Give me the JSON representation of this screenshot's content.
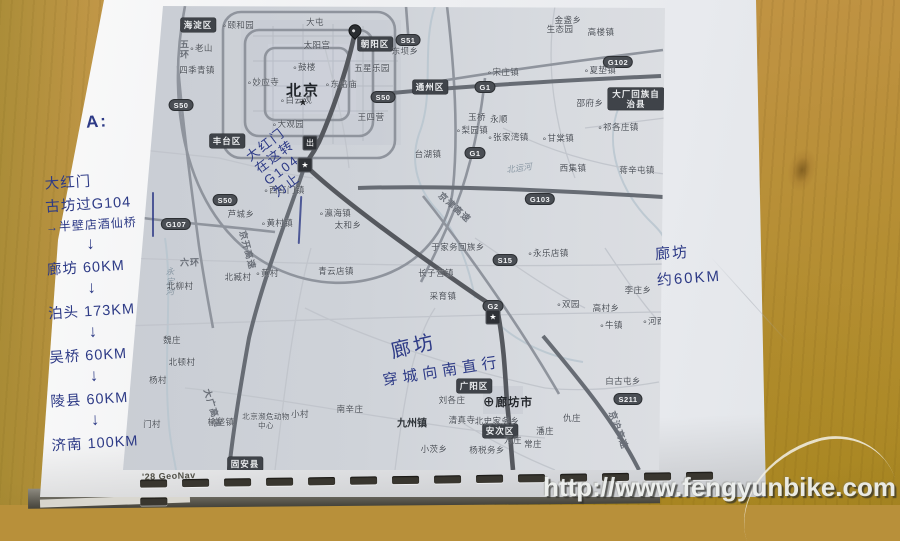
{
  "photo": {
    "watermark": "http://www.fengyunbike.com",
    "map_credit": "'28 GeoNav"
  },
  "handwriting": {
    "label_a": "A:",
    "left_list": [
      {
        "t": "大红门",
        "k": "line"
      },
      {
        "t": "古坊过G104",
        "k": "line"
      },
      {
        "t": "→半壁店酒仙桥",
        "k": "line",
        "small": true
      },
      {
        "t": "↓",
        "k": "arrow"
      },
      {
        "t": "廊坊 60KM",
        "k": "line"
      },
      {
        "t": "↓",
        "k": "arrow"
      },
      {
        "t": "泊头 173KM",
        "k": "line"
      },
      {
        "t": "↓",
        "k": "arrow"
      },
      {
        "t": "吴桥 60KM",
        "k": "line"
      },
      {
        "t": "↓",
        "k": "arrow"
      },
      {
        "t": "陵县 60KM",
        "k": "line"
      },
      {
        "t": "↓",
        "k": "arrow"
      },
      {
        "t": "济南 100KM",
        "k": "line"
      }
    ],
    "map_note_start": [
      "大红门",
      "在这转",
      "G104",
      "为止"
    ],
    "map_note_langfang": {
      "title": "廊坊",
      "line": "穿城向南直行"
    },
    "right_note": [
      "廊坊",
      "约60KM"
    ]
  },
  "binding": {
    "slots": 15
  },
  "map": {
    "labels": [
      {
        "t": "海淀区",
        "x": 75,
        "y": 19,
        "k": "d"
      },
      {
        "t": "朝阳区",
        "x": 252,
        "y": 38,
        "k": "d"
      },
      {
        "t": "通州区",
        "x": 307,
        "y": 81,
        "k": "d"
      },
      {
        "t": "丰台区",
        "x": 104,
        "y": 135,
        "k": "d"
      },
      {
        "t": "大厂回族自治县",
        "x": 513,
        "y": 93,
        "k": "d",
        "wrap": 1
      },
      {
        "t": "广阳区",
        "x": 351,
        "y": 380,
        "k": "d"
      },
      {
        "t": "安次区",
        "x": 377,
        "y": 425,
        "k": "d"
      },
      {
        "t": "固安县",
        "x": 122,
        "y": 458,
        "k": "d"
      },
      {
        "t": "S50",
        "x": 58,
        "y": 99,
        "k": "s"
      },
      {
        "t": "S50",
        "x": 102,
        "y": 194,
        "k": "s"
      },
      {
        "t": "S50",
        "x": 260,
        "y": 91,
        "k": "s"
      },
      {
        "t": "S51",
        "x": 285,
        "y": 34,
        "k": "s"
      },
      {
        "t": "G1",
        "x": 362,
        "y": 81,
        "k": "s"
      },
      {
        "t": "G1",
        "x": 352,
        "y": 147,
        "k": "s"
      },
      {
        "t": "G102",
        "x": 495,
        "y": 56,
        "k": "s"
      },
      {
        "t": "G103",
        "x": 417,
        "y": 193,
        "k": "s"
      },
      {
        "t": "G107",
        "x": 53,
        "y": 218,
        "k": "s"
      },
      {
        "t": "S15",
        "x": 382,
        "y": 254,
        "k": "s"
      },
      {
        "t": "G2",
        "x": 370,
        "y": 300,
        "k": "s"
      },
      {
        "t": "S211",
        "x": 505,
        "y": 393,
        "k": "s"
      },
      {
        "t": "北京",
        "x": 180,
        "y": 84,
        "k": "c"
      },
      {
        "t": "★",
        "x": 180,
        "y": 97,
        "k": "sym"
      },
      {
        "t": "廊坊市",
        "x": 385,
        "y": 396,
        "k": "c2",
        "dot": 2
      },
      {
        "t": "五环",
        "x": 62,
        "y": 44,
        "k": "r",
        "vert": 1
      },
      {
        "t": "六环",
        "x": 67,
        "y": 256,
        "k": "r"
      },
      {
        "t": "京开高速",
        "x": 125,
        "y": 244,
        "k": "r",
        "rot": 75
      },
      {
        "t": "大广高速",
        "x": 90,
        "y": 402,
        "k": "r",
        "rot": 73
      },
      {
        "t": "京津高速",
        "x": 332,
        "y": 201,
        "k": "r",
        "rot": 42
      },
      {
        "t": "京沪高速",
        "x": 496,
        "y": 424,
        "k": "r",
        "rot": 70
      },
      {
        "t": "永定河",
        "x": 47,
        "y": 276,
        "k": "w",
        "vert": 1
      },
      {
        "t": "北运河",
        "x": 396,
        "y": 162,
        "k": "w",
        "rot": -8
      },
      {
        "t": "★",
        "x": 182,
        "y": 159,
        "k": "box"
      },
      {
        "t": "出",
        "x": 187,
        "y": 137,
        "k": "box"
      },
      {
        "t": "★",
        "x": 370,
        "y": 311,
        "k": "box"
      },
      {
        "t": "",
        "x": 232,
        "y": 30,
        "k": "pin"
      },
      {
        "t": "颐和园",
        "x": 115,
        "y": 19,
        "k": "t",
        "dot": 1
      },
      {
        "t": "大屯",
        "x": 192,
        "y": 16,
        "k": "t"
      },
      {
        "t": "太阳宫",
        "x": 194,
        "y": 39,
        "k": "t"
      },
      {
        "t": "老山",
        "x": 78,
        "y": 42,
        "k": "t",
        "dot": 1
      },
      {
        "t": "四季青镇",
        "x": 74,
        "y": 64,
        "k": "t"
      },
      {
        "t": "鼓楼",
        "x": 181,
        "y": 61,
        "k": "t",
        "dot": 1
      },
      {
        "t": "妙应寺",
        "x": 140,
        "y": 76,
        "k": "t",
        "dot": 1
      },
      {
        "t": "东岳庙",
        "x": 218,
        "y": 78,
        "k": "t",
        "dot": 1
      },
      {
        "t": "五星乐园",
        "x": 249,
        "y": 62,
        "k": "t"
      },
      {
        "t": "白云观",
        "x": 173,
        "y": 94,
        "k": "t",
        "dot": 1
      },
      {
        "t": "大观园",
        "x": 165,
        "y": 118,
        "k": "t",
        "dot": 1
      },
      {
        "t": "王四营",
        "x": 248,
        "y": 111,
        "k": "t"
      },
      {
        "t": "金盏乡",
        "x": 445,
        "y": 14,
        "k": "t"
      },
      {
        "t": "生态园",
        "x": 437,
        "y": 23,
        "k": "t"
      },
      {
        "t": "高楼镇",
        "x": 478,
        "y": 26,
        "k": "t"
      },
      {
        "t": "东坝乡",
        "x": 282,
        "y": 45,
        "k": "t"
      },
      {
        "t": "夏垫镇",
        "x": 477,
        "y": 64,
        "k": "t",
        "dot": 1
      },
      {
        "t": "宋庄镇",
        "x": 380,
        "y": 66,
        "k": "t",
        "dot": 1
      },
      {
        "t": "邵府乡",
        "x": 467,
        "y": 97,
        "k": "t"
      },
      {
        "t": "玉桥",
        "x": 354,
        "y": 111,
        "k": "t"
      },
      {
        "t": "永顺",
        "x": 376,
        "y": 113,
        "k": "t"
      },
      {
        "t": "祁各庄镇",
        "x": 495,
        "y": 121,
        "k": "t",
        "dot": 1
      },
      {
        "t": "甘棠镇",
        "x": 435,
        "y": 132,
        "k": "t",
        "dot": 1
      },
      {
        "t": "张家湾镇",
        "x": 385,
        "y": 131,
        "k": "t",
        "dot": 1
      },
      {
        "t": "梨园镇",
        "x": 349,
        "y": 124,
        "k": "t",
        "dot": 1
      },
      {
        "t": "台湖镇",
        "x": 305,
        "y": 148,
        "k": "t"
      },
      {
        "t": "西集镇",
        "x": 450,
        "y": 162,
        "k": "t"
      },
      {
        "t": "蒋辛屯镇",
        "x": 514,
        "y": 164,
        "k": "t"
      },
      {
        "t": "于家务回族乡",
        "x": 335,
        "y": 241,
        "k": "t"
      },
      {
        "t": "永乐店镇",
        "x": 425,
        "y": 247,
        "k": "t",
        "dot": 1
      },
      {
        "t": "长子营镇",
        "x": 313,
        "y": 267,
        "k": "t"
      },
      {
        "t": "采育镇",
        "x": 320,
        "y": 290,
        "k": "t"
      },
      {
        "t": "青云店镇",
        "x": 213,
        "y": 265,
        "k": "t"
      },
      {
        "t": "瀛海镇",
        "x": 212,
        "y": 207,
        "k": "t",
        "dot": 1
      },
      {
        "t": "太和乡",
        "x": 225,
        "y": 219,
        "k": "t"
      },
      {
        "t": "黄村镇",
        "x": 154,
        "y": 217,
        "k": "t",
        "dot": 1
      },
      {
        "t": "西红门镇",
        "x": 161,
        "y": 184,
        "k": "t",
        "dot": 1
      },
      {
        "t": "芦城乡",
        "x": 118,
        "y": 208,
        "k": "t"
      },
      {
        "t": "黄村",
        "x": 144,
        "y": 267,
        "k": "t",
        "dot": 1
      },
      {
        "t": "北臧村",
        "x": 115,
        "y": 271,
        "k": "t"
      },
      {
        "t": "北柳村",
        "x": 57,
        "y": 280,
        "k": "t"
      },
      {
        "t": "魏庄",
        "x": 49,
        "y": 334,
        "k": "t"
      },
      {
        "t": "北顿村",
        "x": 59,
        "y": 356,
        "k": "t"
      },
      {
        "t": "杨村",
        "x": 35,
        "y": 374,
        "k": "t"
      },
      {
        "t": "门村",
        "x": 29,
        "y": 418,
        "k": "t"
      },
      {
        "t": "双园",
        "x": 445,
        "y": 298,
        "k": "t",
        "dot": 1
      },
      {
        "t": "高村乡",
        "x": 483,
        "y": 302,
        "k": "t"
      },
      {
        "t": "牛镇",
        "x": 488,
        "y": 319,
        "k": "t",
        "dot": 1
      },
      {
        "t": "李庄乡",
        "x": 515,
        "y": 284,
        "k": "t"
      },
      {
        "t": "河西",
        "x": 531,
        "y": 315,
        "k": "t",
        "dot": 1
      },
      {
        "t": "榆垡镇",
        "x": 98,
        "y": 416,
        "k": "t"
      },
      {
        "t": "北京濒危动物中心",
        "x": 143,
        "y": 415,
        "k": "t",
        "wrap": 1
      },
      {
        "t": "小村",
        "x": 177,
        "y": 408,
        "k": "t"
      },
      {
        "t": "南辛庄",
        "x": 227,
        "y": 403,
        "k": "t"
      },
      {
        "t": "九州镇",
        "x": 289,
        "y": 416,
        "k": "tb"
      },
      {
        "t": "小茨乡",
        "x": 311,
        "y": 443,
        "k": "t"
      },
      {
        "t": "杨税务乡",
        "x": 364,
        "y": 444,
        "k": "t"
      },
      {
        "t": "北史家务乡",
        "x": 374,
        "y": 415,
        "k": "t"
      },
      {
        "t": "清真寺",
        "x": 339,
        "y": 414,
        "k": "t"
      },
      {
        "t": "刘各庄",
        "x": 329,
        "y": 394,
        "k": "t"
      },
      {
        "t": "万庄",
        "x": 390,
        "y": 434,
        "k": "t"
      },
      {
        "t": "潘庄",
        "x": 422,
        "y": 425,
        "k": "t"
      },
      {
        "t": "常庄",
        "x": 410,
        "y": 438,
        "k": "t"
      },
      {
        "t": "仇庄",
        "x": 449,
        "y": 412,
        "k": "t"
      },
      {
        "t": "白古屯乡",
        "x": 500,
        "y": 375,
        "k": "t"
      }
    ]
  }
}
